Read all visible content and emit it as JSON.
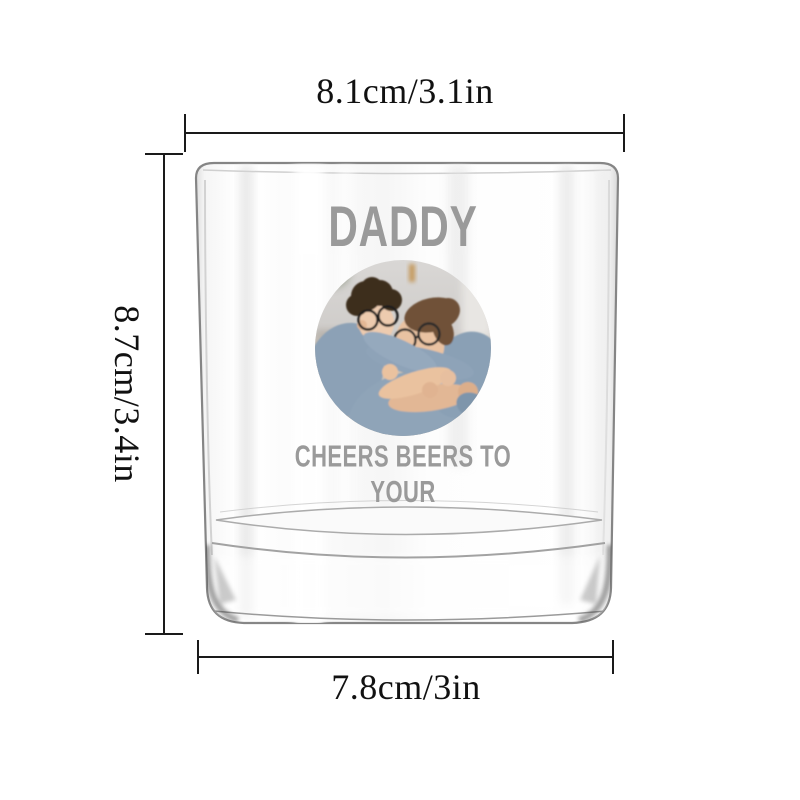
{
  "page": {
    "background_color": "#ffffff"
  },
  "dimensions": {
    "top_width_label": "8.1cm/3.1in",
    "height_label": "8.7cm/3.4in",
    "bottom_width_label": "7.8cm/3in",
    "line_color": "#1a1a1a"
  },
  "engraving": {
    "title": "DADDY",
    "caption": "CHEERS BEERS TO YOUR",
    "color": "#9a9a9a"
  },
  "photo": {
    "alt": "Father and son hugging, both wearing glasses"
  }
}
